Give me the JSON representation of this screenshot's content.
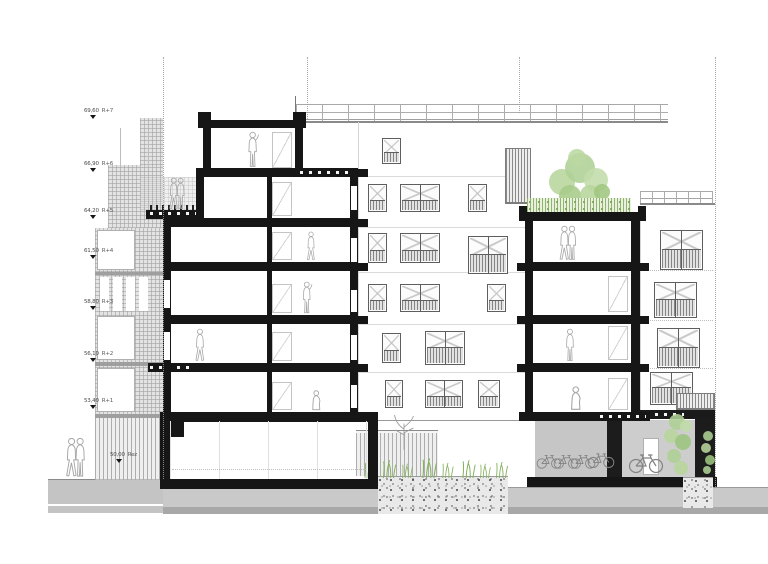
{
  "drawing": {
    "kind": "building-cross-section",
    "levels_count": 8
  },
  "levels": {
    "items": [
      {
        "elevation": "69,60",
        "floor": "R+7"
      },
      {
        "elevation": "66,90",
        "floor": "R+6"
      },
      {
        "elevation": "64,20",
        "floor": "R+5"
      },
      {
        "elevation": "61,50",
        "floor": "R+4"
      },
      {
        "elevation": "58,80",
        "floor": "R+3"
      },
      {
        "elevation": "56,10",
        "floor": "R+2"
      },
      {
        "elevation": "53,40",
        "floor": "R+1"
      },
      {
        "elevation": "50,00",
        "floor": "Rez"
      }
    ]
  },
  "colors": {
    "ink": "#191919",
    "figure_gray": "#a6a6a6",
    "bike_gray": "#828282",
    "ground_gray": "#c9c9c9",
    "hatch_gray": "#e3e3e3",
    "vegetation": [
      "#b7d59c",
      "#aed094",
      "#c2dcab",
      "#a6cb89",
      "#9cc47e",
      "#bcd8a2",
      "#9fc680"
    ],
    "grass": "#83b15c"
  }
}
